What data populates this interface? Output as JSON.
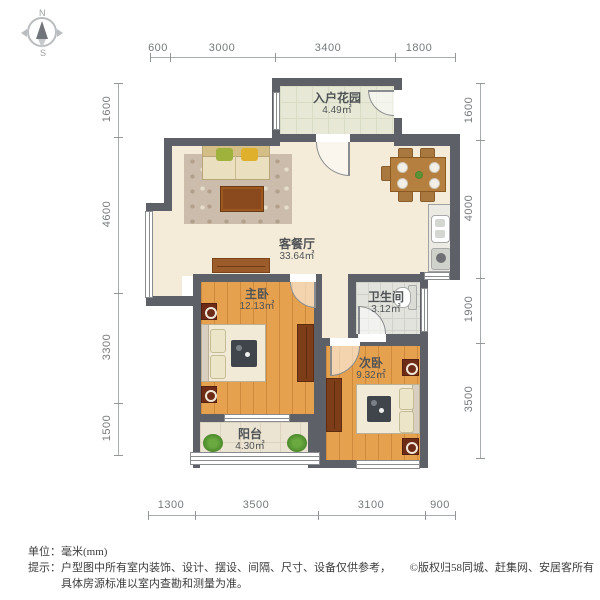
{
  "palette": {
    "wall": "#5d6167",
    "floor_cream": "#f4ebd8",
    "floor_wood": "#e6a14f",
    "floor_garden_tile": "#e7e9d6",
    "floor_bath_tile": "#e2e3dd",
    "floor_balcony_tile": "#ebe4d2",
    "dim_text": "#76797c",
    "room_text": "#4f5356"
  },
  "compass": {
    "north": "N",
    "south": "S"
  },
  "rooms": [
    {
      "name": "入户花园",
      "area": "4.49㎡"
    },
    {
      "name": "客餐厅",
      "area": "33.64㎡"
    },
    {
      "name": "主卧",
      "area": "12.13㎡"
    },
    {
      "name": "卫生间",
      "area": "3.12㎡"
    },
    {
      "name": "次卧",
      "area": "9.32㎡"
    },
    {
      "name": "阳台",
      "area": "4.30㎡"
    }
  ],
  "dimensions": {
    "top": [
      "600",
      "3000",
      "3400",
      "1800"
    ],
    "bottom": [
      "1300",
      "3500",
      "3100",
      "900"
    ],
    "left": [
      "1600",
      "4600",
      "3300",
      "1500"
    ],
    "right": [
      "1600",
      "4000",
      "1900",
      "3500"
    ]
  },
  "footer": {
    "unit": "单位：毫米(mm)",
    "tip": "提示：户型图中所有室内装饰、设计、摆设、间隔、尺寸、设备仅供参考，",
    "tip2": "具体房源标准以室内查勘和测量为准。",
    "copyright": "©版权归58同城、赶集网、安居客所有"
  }
}
